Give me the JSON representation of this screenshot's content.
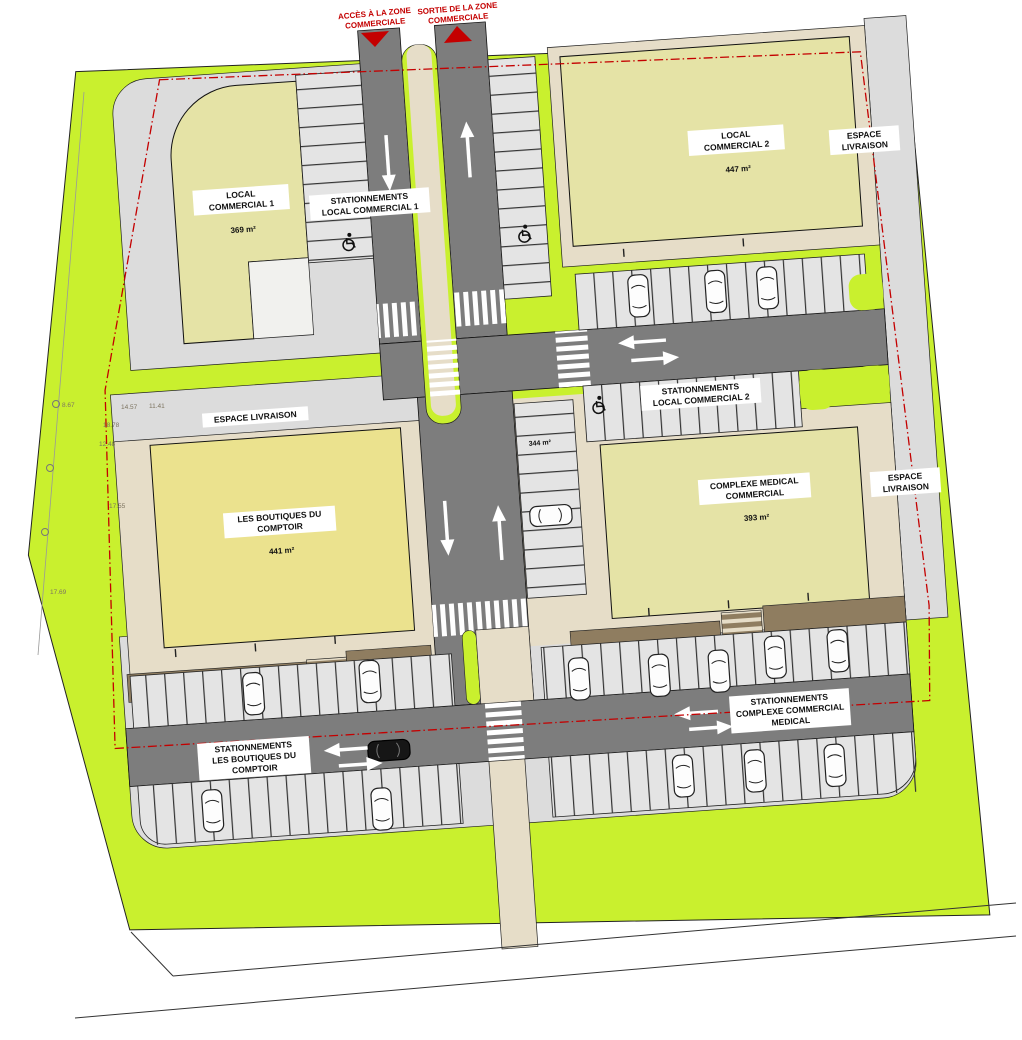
{
  "colors": {
    "site_green": "#c9f02e",
    "road": "#7d7d7d",
    "sidewalk": "#e6ddc8",
    "parking_bg": "#dcdcdc",
    "stall": "#e4e4e4",
    "building": "#e5e3a6",
    "boutiques_building": "#ebe28e",
    "brown": "#8f7d60",
    "boundary_red": "#c40000"
  },
  "entrance": {
    "access_line1": "ACCÈS À LA ZONE",
    "access_line2": "COMMERCIALE",
    "exit_line1": "SORTIE DE LA ZONE",
    "exit_line2": "COMMERCIALE"
  },
  "buildings": {
    "lc1": {
      "name_line1": "LOCAL",
      "name_line2": "COMMERCIAL 1",
      "area": "369 m²"
    },
    "lc2": {
      "name_line1": "LOCAL",
      "name_line2": "COMMERCIAL 2",
      "area": "447 m²"
    },
    "boutiques": {
      "name_line1": "LES BOUTIQUES DU",
      "name_line2": "COMPTOIR",
      "area": "441 m²"
    },
    "medical": {
      "name_line1": "COMPLEXE MEDICAL",
      "name_line2": "COMMERCIAL",
      "area": "393 m²"
    },
    "central_parcel_area": "344 m²"
  },
  "parking_labels": {
    "lc1_line1": "STATIONNEMENTS",
    "lc1_line2": "LOCAL COMMERCIAL 1",
    "lc2_line1": "STATIONNEMENTS",
    "lc2_line2": "LOCAL COMMERCIAL 2",
    "boutiques_line1": "STATIONNEMENTS",
    "boutiques_line2": "LES BOUTIQUES DU",
    "boutiques_line3": "COMPTOIR",
    "medical_line1": "STATIONNEMENTS",
    "medical_line2": "COMPLEXE COMMERCIAL",
    "medical_line3": "MEDICAL"
  },
  "delivery": {
    "top_line1": "ESPACE",
    "top_line2": "LIVRAISON",
    "left": "ESPACE LIVRAISON",
    "right_line1": "ESPACE",
    "right_line2": "LIVRAISON"
  },
  "dimensions": {
    "d1": "8.67",
    "d2": "14.57",
    "d3": "11.41",
    "d4": "18.78",
    "d5": "12.48",
    "d6": "17.55",
    "d7": "17.69"
  }
}
